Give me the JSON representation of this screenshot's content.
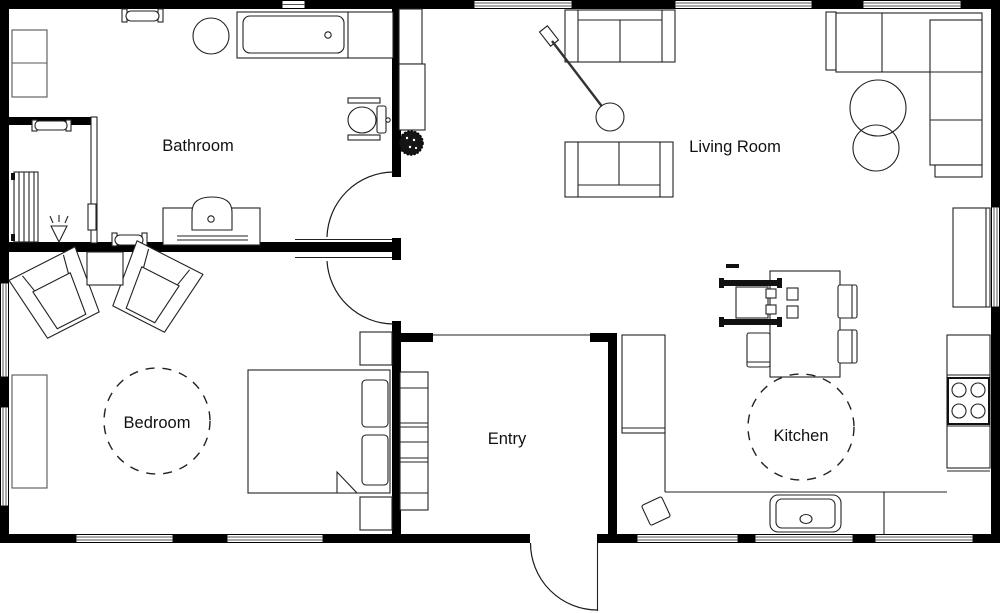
{
  "floor_plan": {
    "title": "Apartment floor plan",
    "background": "#ffffff",
    "wall_color": "#000000",
    "line_color": "#222222",
    "rooms": [
      {
        "id": "bathroom",
        "label": "Bathroom"
      },
      {
        "id": "living-room",
        "label": "Living Room"
      },
      {
        "id": "bedroom",
        "label": "Bedroom"
      },
      {
        "id": "entry",
        "label": "Entry"
      },
      {
        "id": "kitchen",
        "label": "Kitchen"
      }
    ],
    "symbols": [
      "bathtub",
      "toilet",
      "sink-vanity",
      "towel-radiator",
      "radiator",
      "wall-lamp",
      "storage-cabinet",
      "round-table",
      "sofa",
      "loveseat",
      "sectional-sofa",
      "floor-lamp",
      "nesting-tables",
      "plant",
      "armchair",
      "side-table",
      "double-bed",
      "nightstand",
      "dresser",
      "shelving-unit",
      "dining-table",
      "dining-chair",
      "wheelchair",
      "kitchen-counter",
      "stove",
      "kitchen-sink",
      "trash-bin",
      "door-swing",
      "window"
    ]
  }
}
